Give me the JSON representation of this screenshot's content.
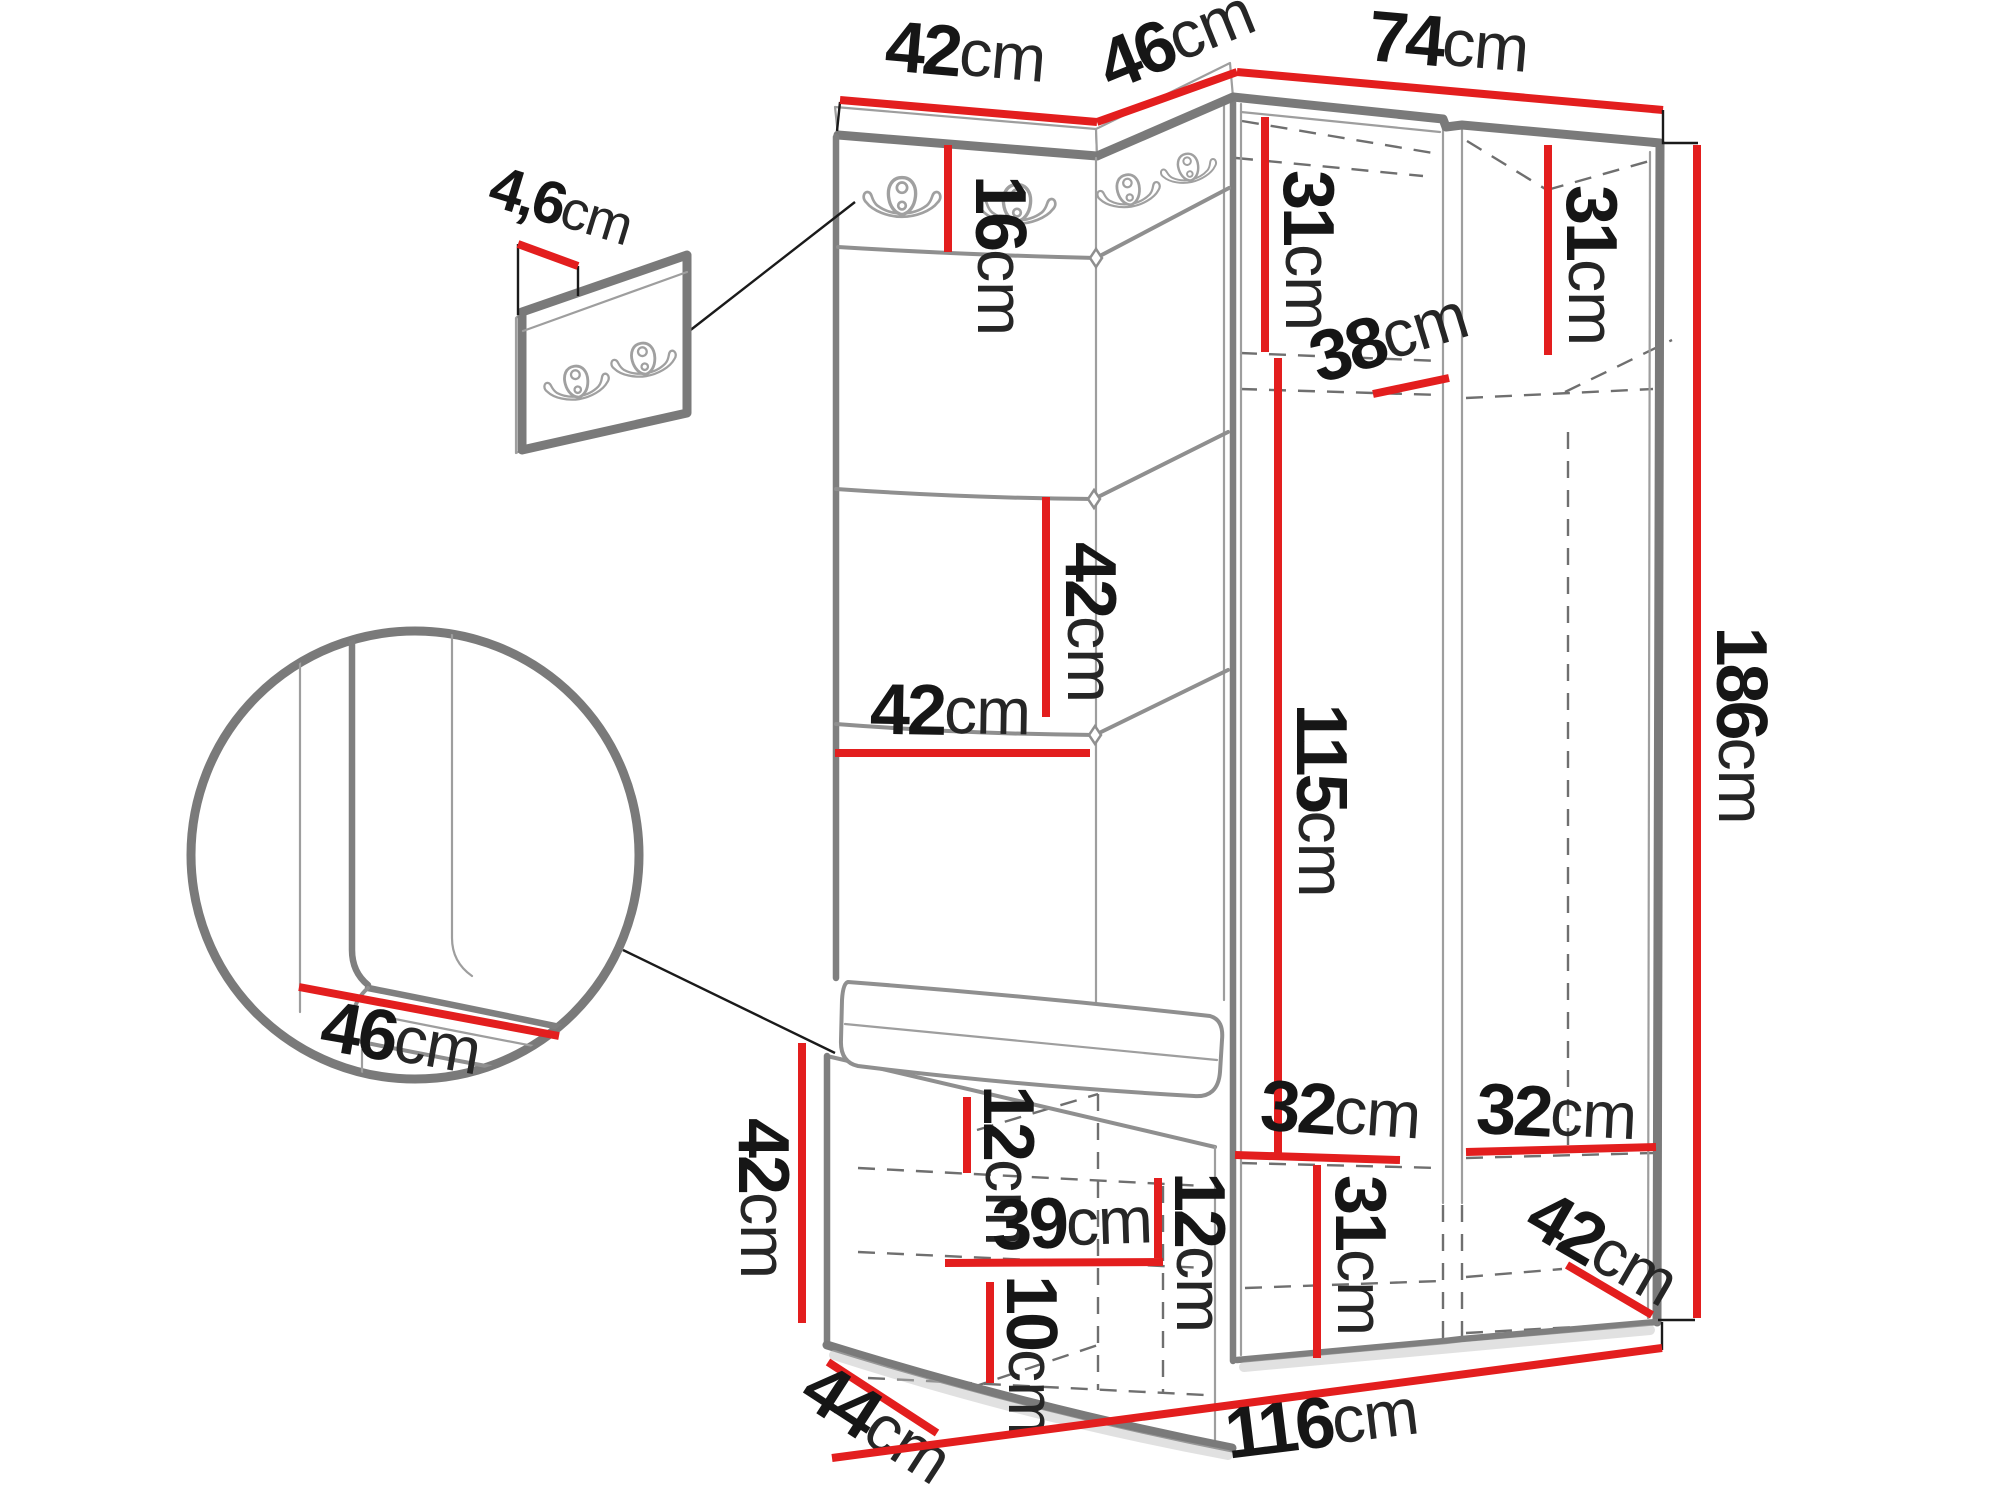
{
  "diagram": {
    "kind": "hallway-furniture-dimension-diagram",
    "unit_suffix": "cm",
    "colors": {
      "dimension_line": "#e31e1e",
      "outline": "#7a7a7a",
      "label": "#161616"
    },
    "dims": {
      "top_panel_w": {
        "value": "42",
        "unit": "cm"
      },
      "top_corner_w": {
        "value": "46",
        "unit": "cm"
      },
      "top_wardrobe_w": {
        "value": "74",
        "unit": "cm"
      },
      "panel_t": {
        "value": "4,6",
        "unit": "cm"
      },
      "hook_band_h": {
        "value": "16",
        "unit": "cm"
      },
      "sect_left_top_h": {
        "value": "31",
        "unit": "cm"
      },
      "sect_right_top_h": {
        "value": "31",
        "unit": "cm"
      },
      "shelf_d": {
        "value": "38",
        "unit": "cm"
      },
      "cushion_h": {
        "value": "42",
        "unit": "cm"
      },
      "cushion_w": {
        "value": "42",
        "unit": "cm"
      },
      "open_h": {
        "value": "115",
        "unit": "cm"
      },
      "total_h": {
        "value": "186",
        "unit": "cm"
      },
      "seat_d": {
        "value": "46",
        "unit": "cm"
      },
      "bench_h": {
        "value": "42",
        "unit": "cm"
      },
      "bench_d": {
        "value": "44",
        "unit": "cm"
      },
      "bench_rail_h": {
        "value": "12",
        "unit": "cm"
      },
      "drawer_w": {
        "value": "39",
        "unit": "cm"
      },
      "drawer_h": {
        "value": "12",
        "unit": "cm"
      },
      "drawer2_h": {
        "value": "10",
        "unit": "cm"
      },
      "shelf_left_w": {
        "value": "32",
        "unit": "cm"
      },
      "shelf_right_w": {
        "value": "32",
        "unit": "cm"
      },
      "bottom_h": {
        "value": "31",
        "unit": "cm"
      },
      "bottom_d": {
        "value": "42",
        "unit": "cm"
      },
      "total_w": {
        "value": "116",
        "unit": "cm"
      }
    }
  }
}
